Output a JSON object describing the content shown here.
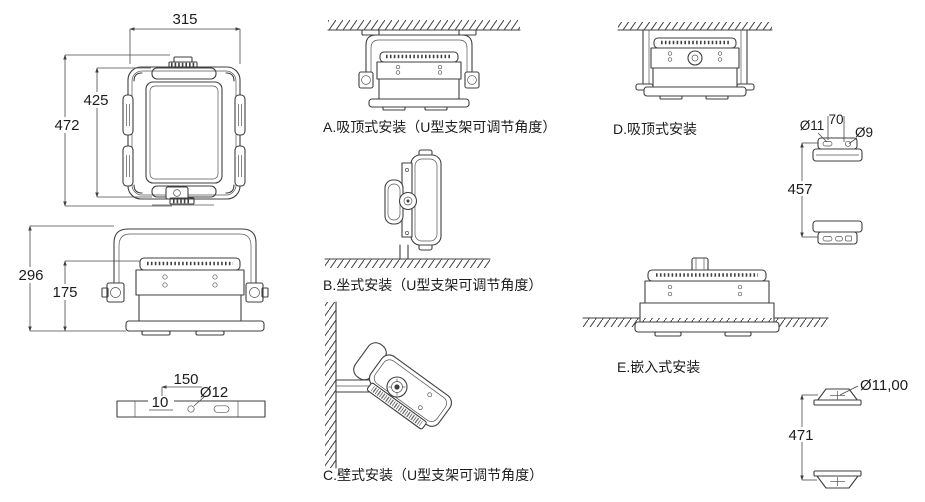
{
  "colors": {
    "line": "#3f3f3f",
    "text": "#1c1c1c",
    "background": "#ffffff"
  },
  "front_view": {
    "width": "315",
    "height_inner": "425",
    "height_total": "472"
  },
  "side_view": {
    "height_total": "296",
    "height_body": "175"
  },
  "mount_bar": {
    "length": "150",
    "hole_diameter": "Ø12",
    "thickness": "10"
  },
  "installations": {
    "a_label": "A.吸顶式安装（U型支架可调节角度）",
    "b_label": "B.坐式安装（U型支架可调节角度）",
    "c_label": "C.壁式安装（U型支架可调节角度）",
    "d_label": "D.吸顶式安装",
    "e_label": "E.嵌入式安装"
  },
  "bracket_top": {
    "hole_left": "Ø11",
    "hole_spacing": "70",
    "hole_right": "Ø9",
    "distance": "457"
  },
  "bracket_bottom": {
    "hole": "Ø11,00",
    "distance": "471"
  }
}
